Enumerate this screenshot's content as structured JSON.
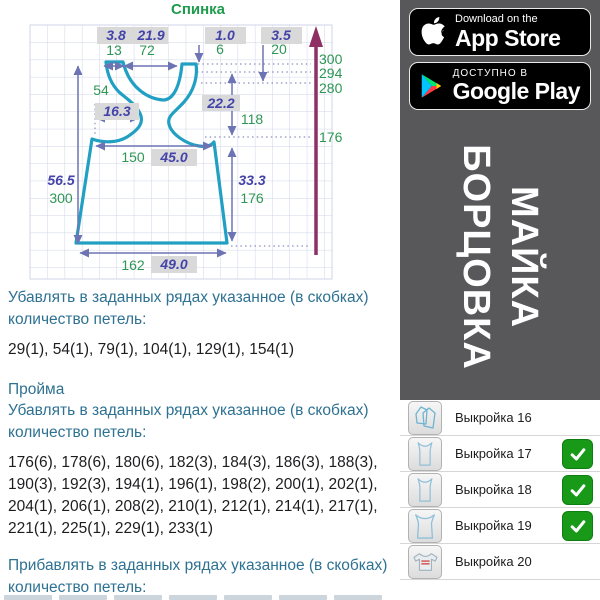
{
  "diagram": {
    "title": "Спинка",
    "labels": {
      "strap_cm": "3.8",
      "neck_cm": "21.9",
      "drop1_cm": "1.0",
      "drop2_cm": "3.5",
      "strap_rows": "13",
      "neck_rows": "72",
      "drop1_rows": "6",
      "drop2_rows": "20",
      "row_300": "300",
      "row_294": "294",
      "row_280": "280",
      "row_176": "176",
      "armhole_rows": "54",
      "armhole_cm": "16.3",
      "cross_cm": "22.2",
      "cross_rows": "118",
      "waist_rows": "150",
      "waist_cm": "45.0",
      "length_cm": "56.5",
      "length_rows": "300",
      "side_cm": "33.3",
      "side_rows": "176",
      "hem_rows": "162",
      "hem_cm": "49.0"
    }
  },
  "instructions": {
    "p1_title": "Убавлять в заданных рядах указанное (в скобках) количество петель:",
    "p1_rows": "29(1), 54(1), 79(1), 104(1), 129(1), 154(1)",
    "armhole_heading": "Пройма",
    "p2_title": "Убавлять в заданных рядах указанное (в скобках) количество петель:",
    "p2_rows": "176(6), 178(6), 180(6), 182(3), 184(3), 186(3), 188(3), 190(3), 192(3), 194(1), 196(1), 198(2), 200(1), 202(1), 204(1), 206(1), 208(2), 210(1), 212(1), 214(1), 217(1), 221(1), 225(1), 229(1), 233(1)",
    "p3_title": "Прибавлять в заданных рядах указанное (в скобках) количество петель:"
  },
  "store_badges": {
    "appstore": {
      "tagline": "Download on the",
      "name": "App Store"
    },
    "googleplay": {
      "tagline": "ДОСТУПНО В",
      "name": "Google Play"
    }
  },
  "banner": {
    "line1": "МАЙКА",
    "line2": "БОРЦОВКА"
  },
  "patterns": [
    {
      "label": "Выкройка 16",
      "checked": false
    },
    {
      "label": "Выкройка 17",
      "checked": true
    },
    {
      "label": "Выкройка 18",
      "checked": true
    },
    {
      "label": "Выкройка 19",
      "checked": true
    },
    {
      "label": "Выкройка 20",
      "checked": false
    }
  ],
  "colors": {
    "outline_teal": "#21a0c3",
    "dim_green": "#2e9655",
    "dim_purple": "#4343aa",
    "arrow_purple": "#6d74b4",
    "axis_maroon": "#8e3063",
    "heading_blue": "#2e7192",
    "check_green": "#189a18",
    "panel_gray": "#58585a"
  }
}
